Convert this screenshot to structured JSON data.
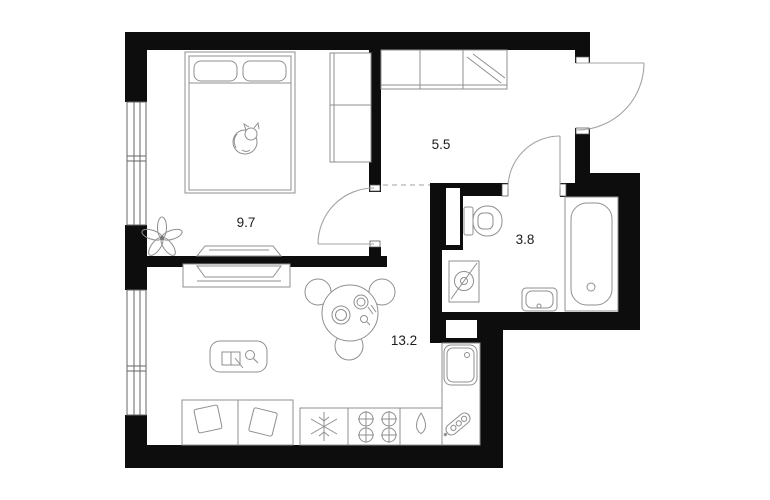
{
  "plan": {
    "title": "one-bedroom-apartment-floor-plan",
    "rooms": {
      "bedroom": {
        "area_label": "9.7"
      },
      "hallway": {
        "area_label": "5.5"
      },
      "bathroom": {
        "area_label": "3.8"
      },
      "living_kitchen": {
        "area_label": "13.2"
      }
    },
    "colors": {
      "wall": "#0d0d0d",
      "background": "#ffffff",
      "furniture_stroke": "#8f8f8f",
      "door_stroke": "#a3a3a3",
      "dashed_boundary": "#b5b5b5",
      "label_text": "#1c1c1c"
    },
    "icons": [
      "double-bed-icon",
      "pillow-icon",
      "sleeping-cat-icon",
      "plant-icon",
      "wardrobe-icon",
      "tv-icon",
      "tv-console-icon",
      "coffee-table-icon",
      "dining-table-icon",
      "chair-icon",
      "sofa-icon",
      "fridge-snowflake-icon",
      "stove-burners-icon",
      "kettle-drop-icon",
      "kitchen-sink-icon",
      "dish-tag-icon",
      "toilet-icon",
      "washing-machine-icon",
      "bathroom-sink-icon",
      "bathtub-icon",
      "window-icon",
      "door-swing-icon",
      "vent-shaft-icon"
    ]
  }
}
